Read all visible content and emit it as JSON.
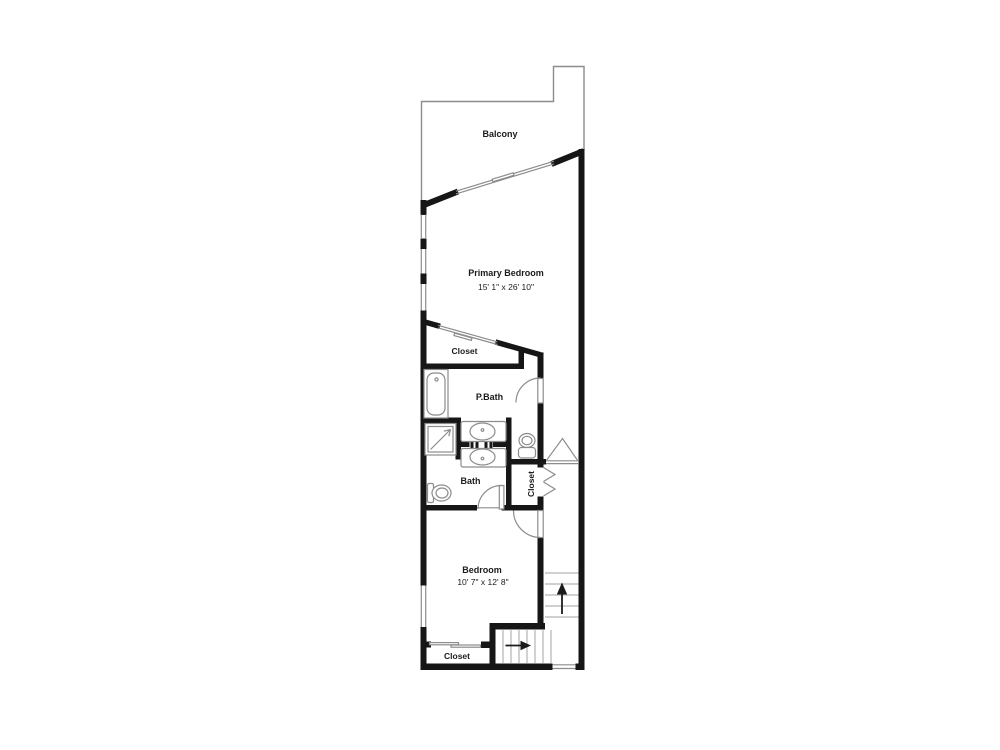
{
  "colors": {
    "wall": "#161616",
    "thin_line": "#8c8c8c",
    "fixture_line": "#8c8c8c",
    "tread_line": "#b3b3b3",
    "text": "#1b1b1b",
    "background": "#ffffff"
  },
  "floor_plan": {
    "balcony": {
      "label": "Balcony"
    },
    "primary_bedroom": {
      "label": "Primary Bedroom",
      "dimensions": "15' 1\" x 26' 10\""
    },
    "primary_closet": {
      "label": "Closet"
    },
    "primary_bath": {
      "label": "P.Bath"
    },
    "bath": {
      "label": "Bath"
    },
    "hall_closet": {
      "label": "Closet"
    },
    "bedroom": {
      "label": "Bedroom",
      "dimensions": "10' 7\" x 12' 8\""
    },
    "bedroom_closet": {
      "label": "Closet"
    }
  }
}
